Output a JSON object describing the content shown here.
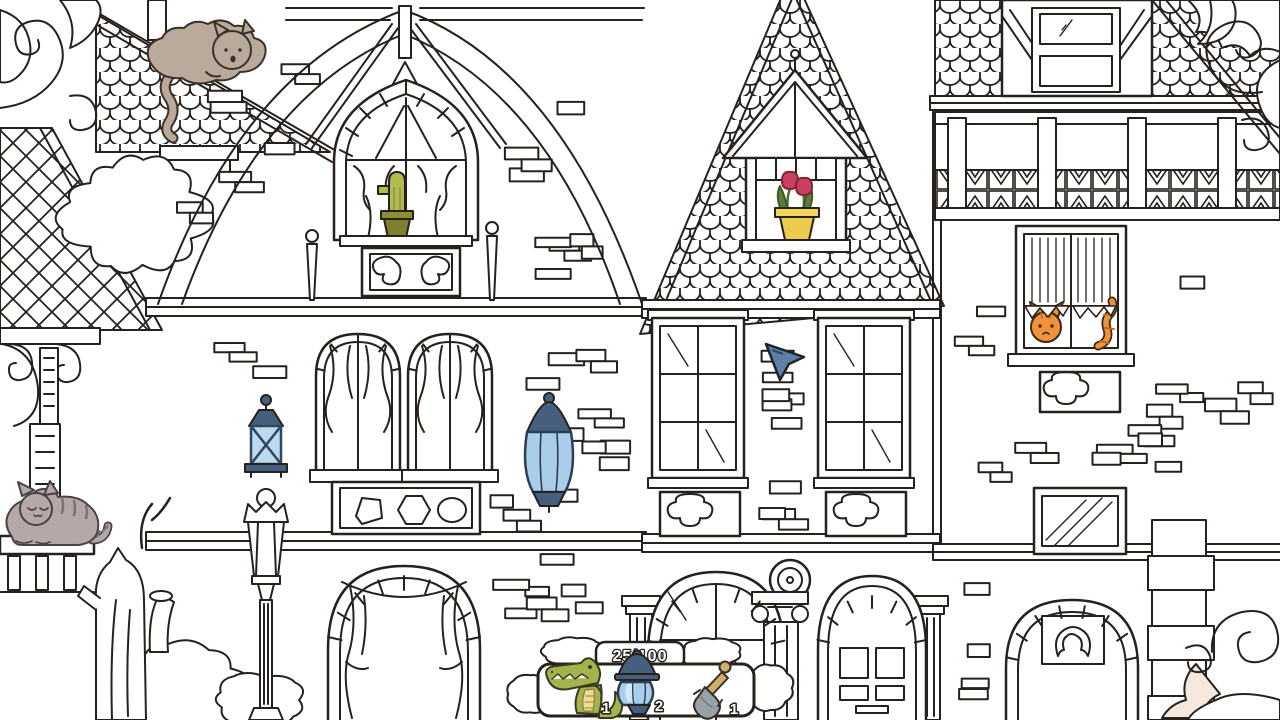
{
  "hud": {
    "counter": "25/100",
    "found": "25",
    "total": "100",
    "items": [
      {
        "name": "crocodile",
        "count": "1",
        "color": "#a4b34c"
      },
      {
        "name": "lantern",
        "count": "2",
        "color": "#a9cdea"
      },
      {
        "name": "shovel",
        "count": "1",
        "color": "#99a0a6"
      }
    ]
  },
  "scene": {
    "style": "black-and-white line-art Victorian mansion, hidden-object coloring scene",
    "colored_objects": [
      {
        "name": "sleeping-cat-on-roof",
        "color": "#b9aa9b"
      },
      {
        "name": "tabby-cat-on-ledge",
        "color": "#b4a8a8"
      },
      {
        "name": "cactus-in-gable-window",
        "color": "#b2ba50"
      },
      {
        "name": "tulips-in-dormer-window",
        "color": "#ca4060"
      },
      {
        "name": "orange-cat-in-window",
        "color": "#f0923b"
      },
      {
        "name": "wall-lantern-left",
        "color": "#bcdaef"
      },
      {
        "name": "wall-lantern-right",
        "color": "#a9cdea"
      }
    ],
    "cursor_color": "#5d80a8"
  }
}
